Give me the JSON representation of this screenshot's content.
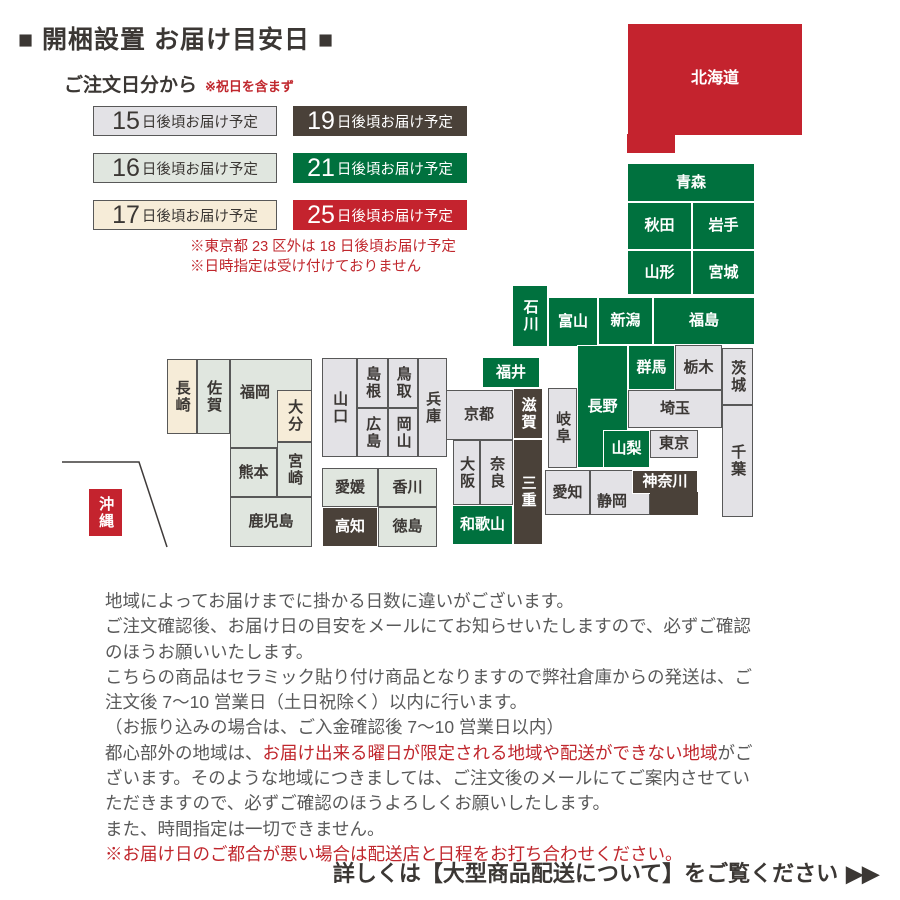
{
  "title": "■ 開梱設置 お届け目安日 ■",
  "subtitle": {
    "label": "ご注文日分から",
    "note": "※祝日を含まず"
  },
  "legend": {
    "items": [
      {
        "days": "15",
        "suffix": "日後頃お届け予定",
        "style": "gray"
      },
      {
        "days": "19",
        "suffix": "日後頃お届け予定",
        "style": "brown"
      },
      {
        "days": "16",
        "suffix": "日後頃お届け予定",
        "style": "graygreen"
      },
      {
        "days": "21",
        "suffix": "日後頃お届け予定",
        "style": "green"
      },
      {
        "days": "17",
        "suffix": "日後頃お届け予定",
        "style": "cream"
      },
      {
        "days": "25",
        "suffix": "日後頃お届け予定",
        "style": "red"
      }
    ],
    "notes": [
      "※東京都 23 区外は 18 日後頃お届け予定",
      "※日時指定は受け付けておりません"
    ]
  },
  "colors": {
    "green": "#00713e",
    "brown": "#4a4139",
    "red": "#c4232e",
    "gray": "#e3e2e6",
    "graygreen": "#e0e6df",
    "cream": "#f6ecd8",
    "note_red": "#c0272d"
  },
  "map": {
    "inset_line_points": "62,462 139,462 167,547",
    "prefectures": [
      {
        "id": "hokkaido",
        "label": "北海道",
        "x": 627,
        "y": 23,
        "w": 176,
        "h": 113,
        "style": "red"
      },
      {
        "id": "hokkaido-ext",
        "label": "",
        "x": 627,
        "y": 134,
        "w": 48,
        "h": 19,
        "style": "red",
        "noborder": true
      },
      {
        "id": "aomori",
        "label": "青森",
        "x": 627,
        "y": 163,
        "w": 128,
        "h": 39,
        "style": "green"
      },
      {
        "id": "akita",
        "label": "秋田",
        "x": 627,
        "y": 202,
        "w": 65,
        "h": 48,
        "style": "green"
      },
      {
        "id": "iwate",
        "label": "岩手",
        "x": 692,
        "y": 202,
        "w": 63,
        "h": 48,
        "style": "green"
      },
      {
        "id": "yamagata",
        "label": "山形",
        "x": 627,
        "y": 250,
        "w": 65,
        "h": 45,
        "style": "green"
      },
      {
        "id": "miyagi",
        "label": "宮城",
        "x": 692,
        "y": 250,
        "w": 63,
        "h": 45,
        "style": "green"
      },
      {
        "id": "niigata",
        "label": "新潟",
        "x": 598,
        "y": 297,
        "w": 55,
        "h": 48,
        "style": "green"
      },
      {
        "id": "fukushima",
        "label": "福島",
        "x": 653,
        "y": 297,
        "w": 102,
        "h": 48,
        "style": "green"
      },
      {
        "id": "ishikawa",
        "label": "石川",
        "x": 512,
        "y": 285,
        "w": 36,
        "h": 62,
        "style": "green",
        "vert": true
      },
      {
        "id": "toyama",
        "label": "富山",
        "x": 548,
        "y": 297,
        "w": 50,
        "h": 50,
        "style": "green"
      },
      {
        "id": "fukui",
        "label": "福井",
        "x": 482,
        "y": 357,
        "w": 58,
        "h": 31,
        "style": "green"
      },
      {
        "id": "nagano",
        "label": "長野",
        "x": 577,
        "y": 345,
        "w": 51,
        "h": 123,
        "style": "green"
      },
      {
        "id": "gunma",
        "label": "群馬",
        "x": 628,
        "y": 345,
        "w": 47,
        "h": 45,
        "style": "green"
      },
      {
        "id": "tochigi",
        "label": "栃木",
        "x": 675,
        "y": 345,
        "w": 47,
        "h": 45,
        "style": "gray"
      },
      {
        "id": "ibaraki",
        "label": "茨城",
        "x": 722,
        "y": 348,
        "w": 31,
        "h": 57,
        "style": "gray",
        "vert": true
      },
      {
        "id": "saitama",
        "label": "埼玉",
        "x": 628,
        "y": 390,
        "w": 94,
        "h": 38,
        "style": "gray"
      },
      {
        "id": "yamanashi",
        "label": "山梨",
        "x": 603,
        "y": 430,
        "w": 47,
        "h": 38,
        "style": "green"
      },
      {
        "id": "tokyo",
        "label": "東京",
        "x": 650,
        "y": 430,
        "w": 48,
        "h": 28,
        "style": "gray"
      },
      {
        "id": "chiba",
        "label": "千葉",
        "x": 722,
        "y": 405,
        "w": 31,
        "h": 112,
        "style": "gray",
        "vert": true
      },
      {
        "id": "shizuoka",
        "label": "静岡",
        "x": 590,
        "y": 470,
        "w": 60,
        "h": 45,
        "style": "gray",
        "lpos": {
          "left": "6px",
          "bottom": "4px"
        }
      },
      {
        "id": "kanagawa",
        "label": "神奈川",
        "x": 632,
        "y": 470,
        "w": 66,
        "h": 24,
        "style": "brown"
      },
      {
        "id": "kanagawa-ext",
        "label": "",
        "x": 650,
        "y": 492,
        "w": 48,
        "h": 23,
        "style": "brown",
        "noborder": true
      },
      {
        "id": "aichi",
        "label": "愛知",
        "x": 545,
        "y": 470,
        "w": 45,
        "h": 45,
        "style": "gray"
      },
      {
        "id": "gifu",
        "label": "岐阜",
        "x": 548,
        "y": 388,
        "w": 29,
        "h": 80,
        "style": "gray",
        "vert": true
      },
      {
        "id": "kyoto",
        "label": "京都",
        "x": 445,
        "y": 390,
        "w": 68,
        "h": 50,
        "style": "gray"
      },
      {
        "id": "shiga",
        "label": "滋賀",
        "x": 513,
        "y": 388,
        "w": 30,
        "h": 51,
        "style": "brown",
        "vert": true
      },
      {
        "id": "osaka",
        "label": "大阪",
        "x": 453,
        "y": 440,
        "w": 27,
        "h": 65,
        "style": "gray",
        "vert": true
      },
      {
        "id": "nara",
        "label": "奈良",
        "x": 480,
        "y": 440,
        "w": 33,
        "h": 65,
        "style": "gray",
        "vert": true
      },
      {
        "id": "mie",
        "label": "三重",
        "x": 513,
        "y": 439,
        "w": 30,
        "h": 106,
        "style": "brown",
        "vert": true
      },
      {
        "id": "wakayama",
        "label": "和歌山",
        "x": 452,
        "y": 505,
        "w": 61,
        "h": 40,
        "style": "green"
      },
      {
        "id": "hyogo",
        "label": "兵庫",
        "x": 418,
        "y": 358,
        "w": 29,
        "h": 99,
        "style": "gray",
        "vert": true
      },
      {
        "id": "tottori",
        "label": "鳥取",
        "x": 388,
        "y": 358,
        "w": 30,
        "h": 50,
        "style": "gray",
        "vert": true
      },
      {
        "id": "okayama",
        "label": "岡山",
        "x": 388,
        "y": 408,
        "w": 30,
        "h": 49,
        "style": "gray",
        "vert": true
      },
      {
        "id": "shimane",
        "label": "島根",
        "x": 357,
        "y": 358,
        "w": 31,
        "h": 50,
        "style": "gray",
        "vert": true
      },
      {
        "id": "hiroshima",
        "label": "広島",
        "x": 357,
        "y": 408,
        "w": 31,
        "h": 49,
        "style": "gray",
        "vert": true
      },
      {
        "id": "yamaguchi",
        "label": "山口",
        "x": 322,
        "y": 358,
        "w": 35,
        "h": 99,
        "style": "gray",
        "vert": true
      },
      {
        "id": "ehime",
        "label": "愛媛",
        "x": 322,
        "y": 468,
        "w": 56,
        "h": 39,
        "style": "graygreen"
      },
      {
        "id": "kagawa",
        "label": "香川",
        "x": 378,
        "y": 468,
        "w": 59,
        "h": 39,
        "style": "graygreen"
      },
      {
        "id": "kochi",
        "label": "高知",
        "x": 322,
        "y": 507,
        "w": 56,
        "h": 40,
        "style": "brown"
      },
      {
        "id": "tokushima",
        "label": "徳島",
        "x": 378,
        "y": 507,
        "w": 59,
        "h": 40,
        "style": "graygreen"
      },
      {
        "id": "fukuoka",
        "label": "福岡",
        "x": 230,
        "y": 359,
        "w": 82,
        "h": 89,
        "style": "graygreen",
        "lpos": {
          "left": "9px",
          "top": "24px"
        }
      },
      {
        "id": "oita",
        "label": "大分",
        "x": 277,
        "y": 390,
        "w": 35,
        "h": 52,
        "style": "cream",
        "vert": true
      },
      {
        "id": "nagasaki",
        "label": "長崎",
        "x": 167,
        "y": 359,
        "w": 30,
        "h": 75,
        "style": "cream",
        "vert": true
      },
      {
        "id": "saga",
        "label": "佐賀",
        "x": 197,
        "y": 359,
        "w": 33,
        "h": 75,
        "style": "graygreen",
        "vert": true
      },
      {
        "id": "kumamoto",
        "label": "熊本",
        "x": 230,
        "y": 448,
        "w": 47,
        "h": 49,
        "style": "graygreen"
      },
      {
        "id": "miyazaki",
        "label": "宮崎",
        "x": 277,
        "y": 442,
        "w": 35,
        "h": 55,
        "style": "graygreen",
        "vert": true
      },
      {
        "id": "kagoshima",
        "label": "鹿児島",
        "x": 230,
        "y": 497,
        "w": 82,
        "h": 50,
        "style": "graygreen"
      },
      {
        "id": "okinawa",
        "label": "沖縄",
        "x": 88,
        "y": 488,
        "w": 35,
        "h": 49,
        "style": "red",
        "vert": true
      }
    ]
  },
  "body": {
    "lines": [
      {
        "segments": [
          {
            "t": "地域によってお届けまでに掛かる日数に違いがございます。"
          }
        ]
      },
      {
        "segments": [
          {
            "t": "ご注文確認後、お届け日の目安をメールにてお知らせいたしますので、必ずご確認"
          }
        ]
      },
      {
        "segments": [
          {
            "t": "のほうお願いいたします。"
          }
        ]
      },
      {
        "segments": [
          {
            "t": "こちらの商品はセラミック貼り付け商品となりますので弊社倉庫からの発送は、ご"
          }
        ]
      },
      {
        "segments": [
          {
            "t": "注文後 7～10 営業日（土日祝除く）以内に行います。"
          }
        ]
      },
      {
        "segments": [
          {
            "t": "（お振り込みの場合は、ご入金確認後 7～10 営業日以内）"
          }
        ]
      },
      {
        "segments": [
          {
            "t": "都心部外の地域は、"
          },
          {
            "t": "お届け出来る曜日が限定される地域や配送ができない地域",
            "red": true
          },
          {
            "t": "がご"
          }
        ]
      },
      {
        "segments": [
          {
            "t": "ざいます。そのような地域につきましては、ご注文後のメールにてご案内させてい"
          }
        ]
      },
      {
        "segments": [
          {
            "t": "ただきますので、必ずご確認のほうよろしくお願いしたします。"
          }
        ]
      },
      {
        "segments": [
          {
            "t": "また、時間指定は一切できません。"
          }
        ]
      },
      {
        "segments": [
          {
            "t": "※お届け日のご都合が悪い場合は配送店と日程をお打ち合わせください。",
            "red": true
          }
        ]
      }
    ]
  },
  "footer": {
    "text": "詳しくは【大型商品配送について】をご覧ください",
    "arrows": "▶▶"
  }
}
